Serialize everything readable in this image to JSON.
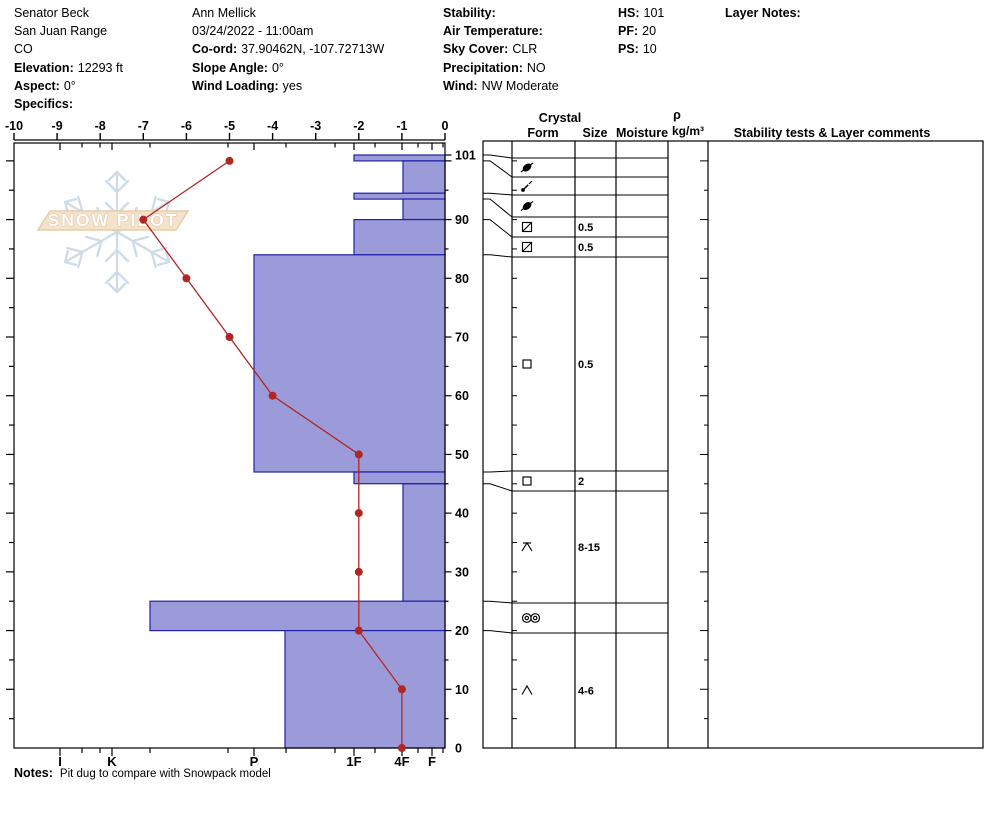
{
  "header": {
    "site": {
      "rows": [
        {
          "label": "",
          "value": "Senator Beck"
        },
        {
          "label": "",
          "value": "San Juan Range"
        },
        {
          "label": "",
          "value": "CO"
        },
        {
          "label": "Elevation:",
          "value": "12293 ft"
        },
        {
          "label": "Aspect:",
          "value": "0°"
        },
        {
          "label": "Specifics:",
          "value": ""
        }
      ]
    },
    "observer": {
      "rows": [
        {
          "label": "",
          "value": "Ann Mellick"
        },
        {
          "label": "",
          "value": "03/24/2022 - 11:00am"
        },
        {
          "label": "Co-ord:",
          "value": "37.90462N, -107.72713W"
        },
        {
          "label": "Slope Angle:",
          "value": "0°"
        },
        {
          "label": "Wind Loading:",
          "value": "yes"
        }
      ]
    },
    "conditions": {
      "rows": [
        {
          "label": "Stability:",
          "value": ""
        },
        {
          "label": "Air Temperature:",
          "value": ""
        },
        {
          "label": "Sky Cover:",
          "value": "CLR"
        },
        {
          "label": "Precipitation:",
          "value": "NO"
        },
        {
          "label": "Wind:",
          "value": "NW Moderate"
        }
      ]
    },
    "snow_heights": {
      "rows": [
        {
          "label": "HS:",
          "value": "101"
        },
        {
          "label": "PF:",
          "value": "20"
        },
        {
          "label": "PS:",
          "value": "10"
        }
      ]
    },
    "layer_notes": {
      "label": "Layer Notes:",
      "value": ""
    }
  },
  "logo": {
    "text": "SNOW PILOT"
  },
  "table_headers": {
    "crystal": "Crystal",
    "form": "Form",
    "size": "Size",
    "moisture": "Moisture",
    "rho": "ρ",
    "rho_units": "kg/m³",
    "comments": "Stability tests & Layer comments"
  },
  "notes": {
    "label": "Notes:",
    "text": "Pit dug to compare with Snowpack model"
  },
  "chart_data": {
    "type": "snow-profile",
    "title": "Snow pit hardness / temperature profile",
    "temperature_axis": {
      "unit": "°C",
      "range": [
        -10,
        0
      ],
      "tick_values": [
        -10,
        -9,
        -8,
        -7,
        -6,
        -5,
        -4,
        -3,
        -2,
        -1,
        0
      ]
    },
    "hardness_axis": {
      "labels": [
        "I",
        "K",
        "P",
        "1F",
        "4F",
        "F"
      ]
    },
    "depth_axis": {
      "unit": "cm",
      "range": [
        0,
        101
      ],
      "hs": 101,
      "labels": [
        101,
        90,
        80,
        70,
        60,
        50,
        40,
        30,
        20,
        10,
        0
      ]
    },
    "temperature_profile": [
      {
        "depth": 100,
        "temp": -5
      },
      {
        "depth": 90,
        "temp": -7
      },
      {
        "depth": 80,
        "temp": -6
      },
      {
        "depth": 70,
        "temp": -5
      },
      {
        "depth": 60,
        "temp": -4
      },
      {
        "depth": 50,
        "temp": -2
      },
      {
        "depth": 40,
        "temp": -2
      },
      {
        "depth": 30,
        "temp": -2
      },
      {
        "depth": 20,
        "temp": -2
      },
      {
        "depth": 10,
        "temp": -1
      },
      {
        "depth": 0,
        "temp": -1
      }
    ],
    "layers": [
      {
        "top": 101,
        "bottom": 100,
        "hardness": "1F",
        "form": "pp-rimed",
        "size": "",
        "moisture": "",
        "density": "",
        "comments": ""
      },
      {
        "top": 100,
        "bottom": 94.5,
        "hardness": "4F",
        "form": "df",
        "size": "",
        "moisture": "",
        "density": "",
        "comments": ""
      },
      {
        "top": 94.5,
        "bottom": 93.5,
        "hardness": "1F",
        "form": "pp-rimed",
        "size": "",
        "moisture": "",
        "density": "",
        "comments": ""
      },
      {
        "top": 93.5,
        "bottom": 90,
        "hardness": "4F",
        "form": "fcxr",
        "size": "0.5",
        "moisture": "",
        "density": "",
        "comments": ""
      },
      {
        "top": 90,
        "bottom": 84,
        "hardness": "1F",
        "form": "fcxr",
        "size": "0.5",
        "moisture": "",
        "density": "",
        "comments": ""
      },
      {
        "top": 84,
        "bottom": 47,
        "hardness": "P",
        "form": "fc",
        "size": "0.5",
        "moisture": "",
        "density": "",
        "comments": ""
      },
      {
        "top": 47,
        "bottom": 45,
        "hardness": "1F",
        "form": "fc",
        "size": "2",
        "moisture": "",
        "density": "",
        "comments": ""
      },
      {
        "top": 45,
        "bottom": 25,
        "hardness": "4F",
        "form": "dh-capped",
        "size": "8-15",
        "moisture": "",
        "density": "",
        "comments": ""
      },
      {
        "top": 25,
        "bottom": 20,
        "hardness": "K-",
        "form": "mf-crust",
        "size": "",
        "moisture": "",
        "density": "",
        "comments": ""
      },
      {
        "top": 20,
        "bottom": 0,
        "hardness": "P-",
        "form": "dh",
        "size": "4-6",
        "moisture": "",
        "density": "",
        "comments": ""
      }
    ],
    "colors": {
      "bar_fill": "#9b9bda",
      "bar_stroke": "#2121a8",
      "temp_line": "#b12622",
      "axis": "#000000",
      "logo_band_fill": "#f4e3ca",
      "logo_band_stroke": "#e6cda6",
      "snowflake": "#cfdce8"
    },
    "legend_position": "none",
    "grid": false
  }
}
